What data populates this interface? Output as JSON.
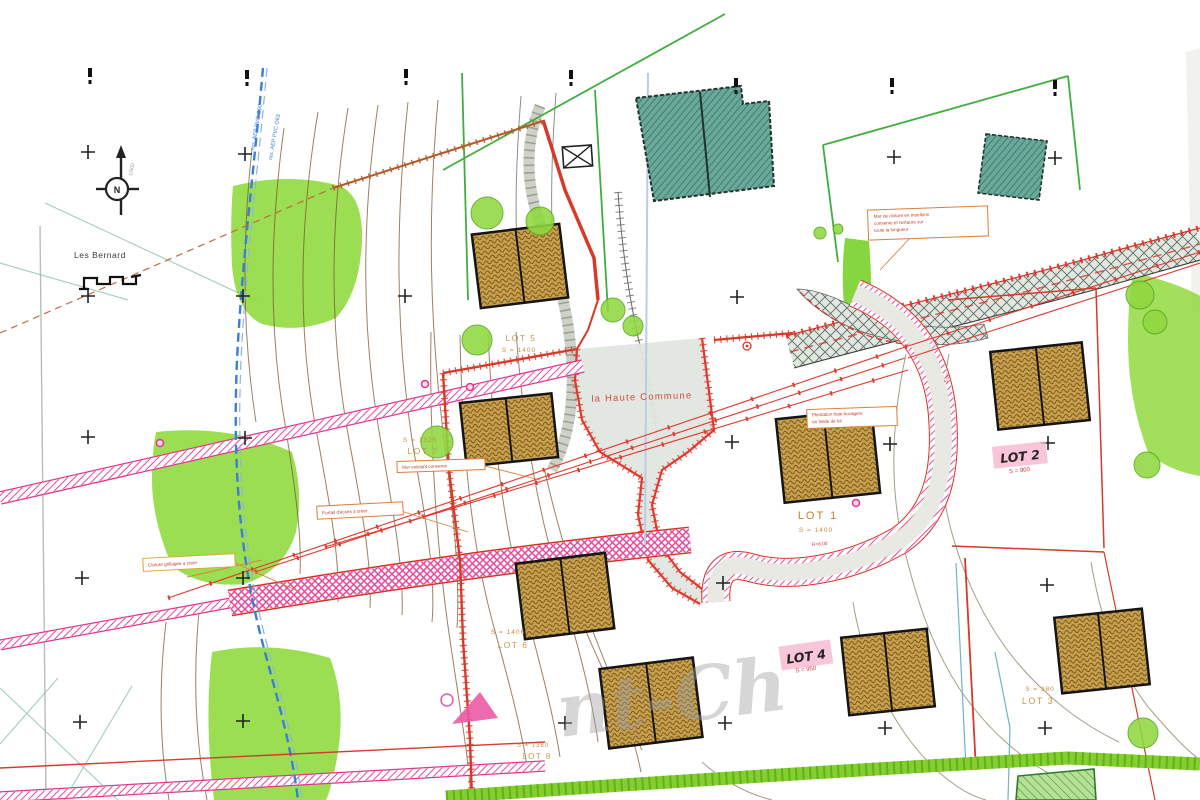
{
  "map": {
    "watermark_fragment": "nt-Ch",
    "compass": {
      "label": "N",
      "note": "1/500"
    },
    "places": [
      {
        "id": "les-bernard",
        "text": "Les Bernard"
      },
      {
        "id": "la-haute-commune",
        "text": "la Haute Commune"
      }
    ],
    "lots": [
      {
        "id": "lot-1",
        "label": "LOT 1",
        "area": "S = 1400",
        "style": "printed-orange"
      },
      {
        "id": "lot-2",
        "label": "LOT 2",
        "area": "S = 900",
        "style": "handwritten-highlight"
      },
      {
        "id": "lot-3",
        "label": "LOT 3",
        "area": "S = 980",
        "style": "printed-light"
      },
      {
        "id": "lot-4",
        "label": "LOT 4",
        "area": "S = 950",
        "style": "handwritten-highlight"
      },
      {
        "id": "lot-5",
        "label": "LOT 5",
        "area": "S = 1400",
        "style": "printed-light"
      },
      {
        "id": "lot-6",
        "label": "LOT 6",
        "area": "S = 1406",
        "style": "printed-light"
      },
      {
        "id": "lot-7",
        "label": "LOT 7",
        "area": "S = 1325",
        "style": "printed-light"
      },
      {
        "id": "lot-8",
        "label": "LOT 8",
        "area": "S = 1380",
        "style": "printed-light"
      }
    ],
    "notes": [
      {
        "id": "note-top-right",
        "lines": [
          "Mur de cloture en moellons",
          "conserve et restaure sur",
          "toute la longueur"
        ]
      },
      {
        "id": "note-lot1",
        "lines": [
          "Plantation haie bocagere",
          "en limite de lot"
        ]
      },
      {
        "id": "note-left",
        "lines": [
          "Cloture grillagee a creer"
        ]
      },
      {
        "id": "note-center-left",
        "lines": [
          "Portail d'acces a creer"
        ]
      },
      {
        "id": "note-center",
        "lines": [
          "Mur existant conserve"
        ]
      }
    ],
    "utility_labels": [
      {
        "text": "res. AEP PVC O90"
      },
      {
        "text": "res. AEP PVC O63"
      }
    ],
    "dimensions": [
      {
        "text": "5.00"
      },
      {
        "text": "R=8.00"
      }
    ],
    "colors": {
      "vegetation_green": "#8bd832",
      "road_pink": "#e8479b",
      "boundary_red": "#d63a2a",
      "existing_building_teal": "#6aa899",
      "proposed_building_gold": "#c8a04d",
      "water_main_blue": "#3b7fd4"
    }
  }
}
